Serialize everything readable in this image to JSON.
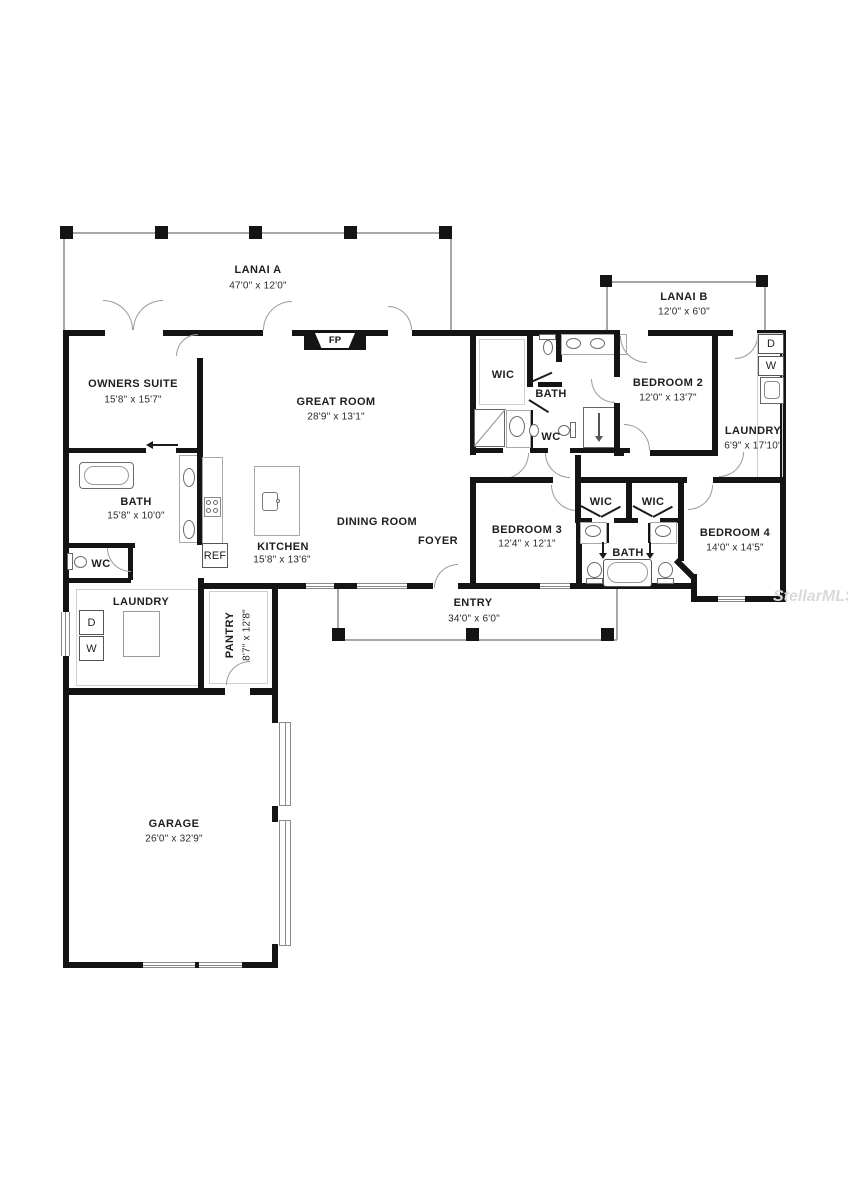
{
  "watermark": "StellarMLS",
  "rooms": {
    "lanai_a": {
      "name": "LANAI A",
      "dims": "47'0\" x 12'0\""
    },
    "lanai_b": {
      "name": "LANAI B",
      "dims": "12'0\" x 6'0\""
    },
    "owners_suite": {
      "name": "OWNERS SUITE",
      "dims": "15'8\" x 15'7\""
    },
    "great_room": {
      "name": "GREAT ROOM",
      "dims": "28'9\" x 13'1\""
    },
    "bath_owners": {
      "name": "BATH",
      "dims": "15'8\" x 10'0\""
    },
    "wc_owners": {
      "name": "WC"
    },
    "laundry_left": {
      "name": "LAUNDRY"
    },
    "pantry": {
      "name": "PANTRY",
      "dims": "8'7\" x 12'8\""
    },
    "kitchen": {
      "name": "KITCHEN",
      "dims": "15'8\" x 13'6\""
    },
    "dining": {
      "name": "DINING ROOM"
    },
    "foyer": {
      "name": "FOYER"
    },
    "entry": {
      "name": "ENTRY",
      "dims": "34'0\" x 6'0\""
    },
    "garage": {
      "name": "GARAGE",
      "dims": "26'0\" x 32'9\""
    },
    "wic_mid": {
      "name": "WIC"
    },
    "bath_mid": {
      "name": "BATH"
    },
    "wc_mid": {
      "name": "WC"
    },
    "bedroom2": {
      "name": "BEDROOM 2",
      "dims": "12'0\" x 13'7\""
    },
    "laundry_right": {
      "name": "LAUNDRY",
      "dims": "6'9\" x 17'10\""
    },
    "bedroom3": {
      "name": "BEDROOM 3",
      "dims": "12'4\" x 12'1\""
    },
    "wic_3": {
      "name": "WIC"
    },
    "wic_4": {
      "name": "WIC"
    },
    "bath_shared": {
      "name": "BATH"
    },
    "bedroom4": {
      "name": "BEDROOM 4",
      "dims": "14'0\" x 14'5\""
    }
  },
  "fixtures": {
    "fireplace": "FP",
    "refrigerator": "REF",
    "dryer": "D",
    "washer": "W"
  }
}
